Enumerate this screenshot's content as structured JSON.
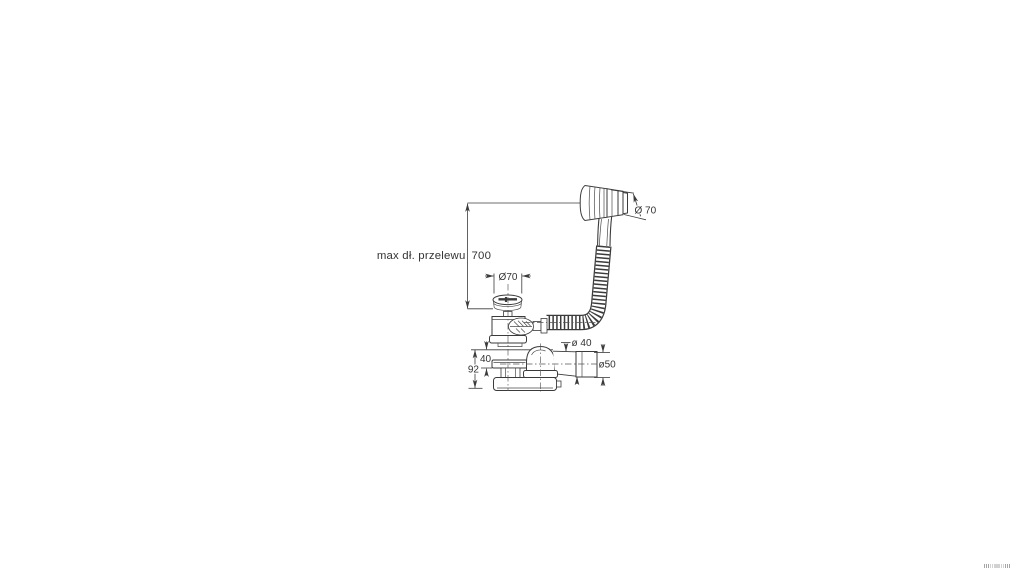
{
  "drawing": {
    "dimensions": {
      "overflow_length_label": "max dł. przelewu",
      "overflow_length_value": "700",
      "plug_diameter": "Ø70",
      "handle_diameter": "Ø 70",
      "waste_pipe_diameter": "ø 40",
      "outlet_diameter": "ø50",
      "flange_height": "40",
      "total_height": "92"
    },
    "colors": {
      "line": "#3b3b3b",
      "background": "#ffffff"
    }
  }
}
